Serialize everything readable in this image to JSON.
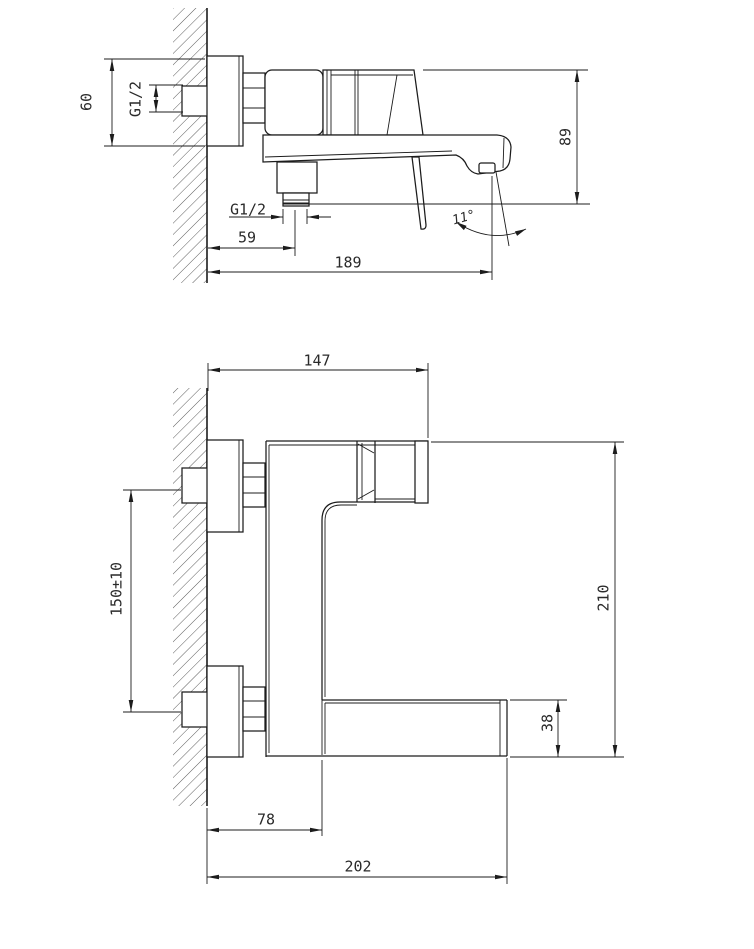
{
  "drawing": {
    "type": "technical-drawing",
    "subject": "wall-mounted bath mixer faucet, two orthographic views with dimensions",
    "colors": {
      "line": "#1c1c1c",
      "background": "#ffffff",
      "hatch": "#4a4a4a",
      "label": "#2a2a2a"
    },
    "views": {
      "side": "side profile view (top)",
      "front": "front elevation view (bottom)"
    }
  },
  "dims": {
    "side_escutcheon_height": "60",
    "side_inlet_thread": "G1/2",
    "side_height": "89",
    "side_outlet_thread": "G1/2",
    "side_outlet_offset": "59",
    "side_reach": "189",
    "side_stream_angle": "11°",
    "front_handle_reach": "147",
    "front_inlet_spacing": "150±10",
    "front_overall_height": "210",
    "front_spout_height": "38",
    "front_riser_offset": "78",
    "front_overall_reach": "202"
  }
}
